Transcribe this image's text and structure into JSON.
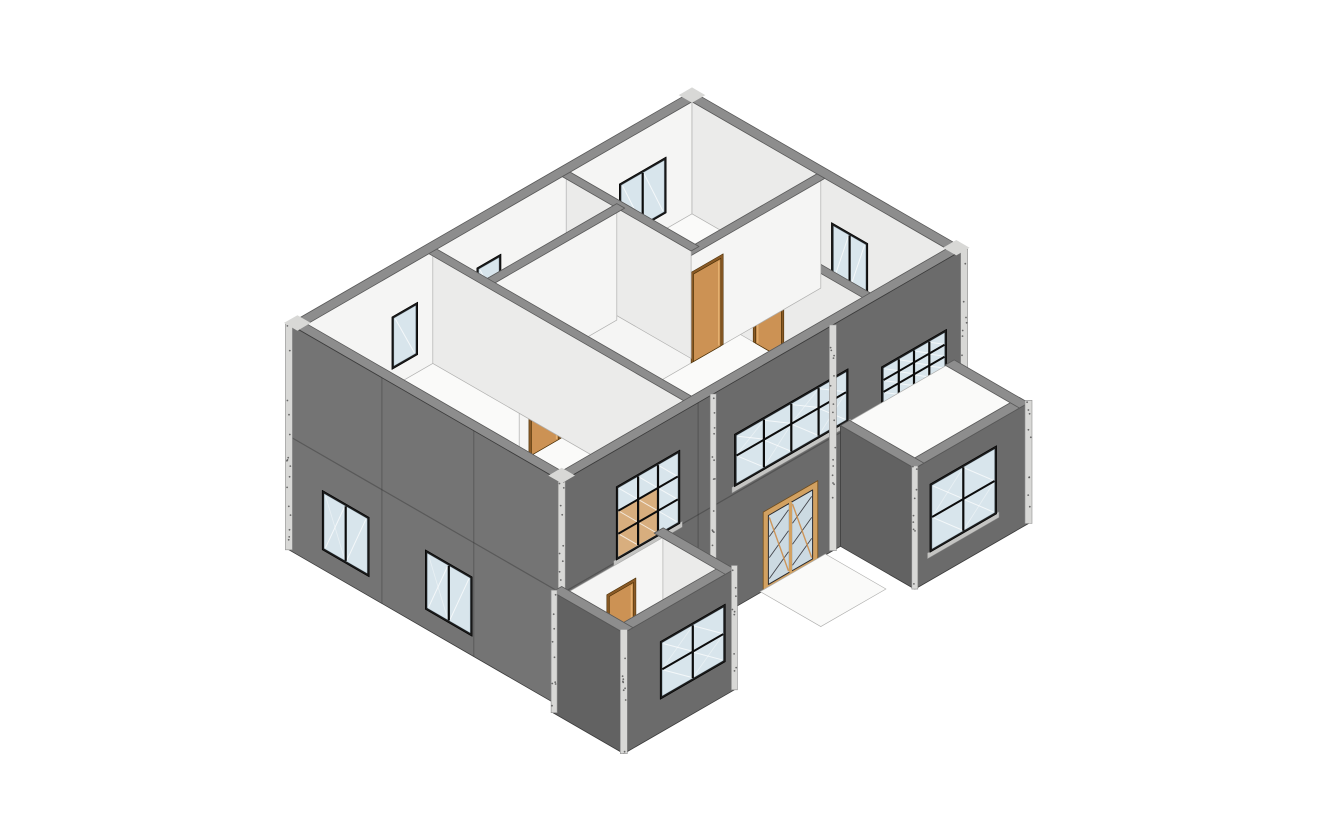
{
  "meta": {
    "title": "3D axonometric section view of a two-story building model"
  },
  "colors": {
    "bg": "#ffffff",
    "wallSW": "#747474",
    "wallSE": "#6b6b6b",
    "wallDark": "#626262",
    "cap": "#8d8d8d",
    "innerA": "#f5f5f4",
    "innerB": "#ebebea",
    "floor": "#fafaf9",
    "shaft": "#efefee",
    "shaftSide": "#e3e3e2",
    "trim": "#d8d8d6",
    "trimLight": "#b5b5b3",
    "speckle": "#565656",
    "frame": "#1a1a1a",
    "mullion": "#0c0c0c",
    "glass": "#d8e5ec",
    "glassTan": "#d8ae7e",
    "sill": "#c4c4c2",
    "door": "#cc9254",
    "doorLit": "#e5b271",
    "doorJamb": "#8a5a26",
    "entryFrame": "#d2a161",
    "entryGlass": "#ccdae2"
  },
  "projection": {
    "scale": 35,
    "ox": 692,
    "oy": 317
  },
  "scene": [
    {
      "t": "wx",
      "n": "stair-shaft-back-wall",
      "x": 7.5,
      "y0": 2.95,
      "y1": 4.9,
      "z0": 0.2,
      "z1": 3.25,
      "f": "shaftSide"
    },
    {
      "t": "top",
      "n": "stair-shaft-floor",
      "z": 0.2,
      "x0": 7.5,
      "x1": 8.75,
      "y0": 2.95,
      "y1": 4.9,
      "f": "shaft"
    },
    {
      "t": "doory",
      "n": "stair-ground-door",
      "y": 2.96,
      "x0": 7.72,
      "x1": 8.5,
      "z0": 0.5,
      "z1": 2.85
    },
    {
      "t": "top",
      "n": "upper-floor-slab",
      "z": 3.25,
      "x0": 0.25,
      "x1": 8.75,
      "y0": 0.25,
      "y1": 13.05,
      "hole": [
        7.5,
        8.75,
        2.95,
        4.9
      ],
      "f": "floor",
      "e": "l"
    },
    {
      "t": "top",
      "n": "stair-opening-trim",
      "z": 3.3,
      "x0": 7.36,
      "x1": 7.52,
      "y0": 2.95,
      "y1": 4.98,
      "f": "trimLight"
    },
    {
      "t": "top",
      "n": "stair-opening-trim",
      "z": 3.3,
      "x0": 7.36,
      "x1": 8.75,
      "y0": 4.86,
      "y1": 5.0,
      "f": "trimLight"
    },
    {
      "t": "wx",
      "n": "inner-wall-nw",
      "x": 0.3,
      "y0": 0.3,
      "y1": 13.05,
      "z0": 3.25,
      "z1": 6.45,
      "f": "innerA",
      "e": "l"
    },
    {
      "t": "winx",
      "n": "interior-window-nw-1",
      "x": 0.3,
      "y0": 1.15,
      "y1": 2.7,
      "z0": 3.7,
      "z1": 5.3,
      "cols": 2,
      "rows": 1
    },
    {
      "t": "winx",
      "n": "interior-window-nw-2",
      "x": 0.3,
      "y0": 6.6,
      "y1": 7.4,
      "z0": 3.75,
      "z1": 5.25,
      "cols": 1,
      "rows": 1
    },
    {
      "t": "winx",
      "n": "interior-window-nw-3",
      "x": 0.3,
      "y0": 9.35,
      "y1": 10.2,
      "z0": 3.75,
      "z1": 5.25,
      "cols": 1,
      "rows": 1
    },
    {
      "t": "wy",
      "n": "inner-wall-ne",
      "y": 0.3,
      "x0": 0.3,
      "x1": 8.75,
      "z0": 3.25,
      "z1": 6.45,
      "f": "innerB",
      "e": "l"
    },
    {
      "t": "winy",
      "n": "interior-window-ne-1",
      "y": 0.3,
      "x0": 4.9,
      "x1": 6.1,
      "z0": 3.7,
      "z1": 5.3,
      "cols": 2,
      "rows": 1
    },
    {
      "t": "winy",
      "n": "interior-window-ne-2",
      "y": 0.3,
      "x0": 7.55,
      "x1": 8.45,
      "z0": 3.7,
      "z1": 5.25,
      "cols": 1,
      "rows": 1
    },
    {
      "t": "top",
      "n": "wall-cap-nw",
      "z": 6.45,
      "x0": 0,
      "x1": 0.3,
      "y0": 0,
      "y1": 13.3,
      "f": "cap",
      "e": "c"
    },
    {
      "t": "top",
      "n": "wall-cap-ne",
      "z": 6.45,
      "x0": 0,
      "x1": 9,
      "y0": 0,
      "y1": 0.3,
      "f": "cap",
      "e": "c"
    },
    {
      "t": "wy",
      "n": "partition-wall-right",
      "y": 2.95,
      "x0": 4.55,
      "x1": 8.75,
      "z0": 3.25,
      "z1": 6.45,
      "f": "innerB",
      "e": "l"
    },
    {
      "t": "doory",
      "n": "interior-door-3",
      "y": 2.95,
      "x0": 5.05,
      "x1": 5.9,
      "z0": 3.25,
      "z1": 5.6
    },
    {
      "t": "top",
      "n": "partition-cap",
      "z": 6.45,
      "x0": 4.45,
      "x1": 8.75,
      "y0": 2.82,
      "y1": 3.08,
      "f": "cap",
      "e": "c"
    },
    {
      "t": "wx",
      "n": "partition-wall-mid",
      "x": 4.55,
      "y0": 0.3,
      "y1": 10.25,
      "z0": 3.25,
      "z1": 6.45,
      "f": "innerA",
      "e": "l"
    },
    {
      "t": "doorx",
      "n": "interior-door-2",
      "x": 4.55,
      "y0": 3.6,
      "y1": 4.5,
      "z0": 3.25,
      "z1": 5.75
    },
    {
      "t": "doorx",
      "n": "interior-door-1",
      "x": 4.55,
      "y0": 8.95,
      "y1": 9.85,
      "z0": 3.25,
      "z1": 5.8
    },
    {
      "t": "top",
      "n": "partition-cap",
      "z": 6.45,
      "x0": 4.42,
      "x1": 4.68,
      "y0": 0.3,
      "y1": 10.25,
      "f": "cap",
      "e": "c"
    },
    {
      "t": "wy",
      "n": "partition-wall-left",
      "y": 4.45,
      "x0": 0.3,
      "x1": 4.42,
      "z0": 3.25,
      "z1": 6.45,
      "f": "innerB",
      "e": "l"
    },
    {
      "t": "top",
      "n": "partition-cap",
      "z": 6.45,
      "x0": 0.3,
      "x1": 4.55,
      "y0": 4.32,
      "y1": 4.58,
      "f": "cap",
      "e": "c"
    },
    {
      "t": "wx",
      "n": "partition-wall-small",
      "x": 2.1,
      "y0": 4.58,
      "y1": 8.85,
      "z0": 3.25,
      "z1": 6.45,
      "f": "innerA",
      "e": "l"
    },
    {
      "t": "top",
      "n": "partition-cap",
      "z": 6.45,
      "x0": 1.97,
      "x1": 2.23,
      "y0": 4.45,
      "y1": 8.85,
      "f": "cap",
      "e": "c"
    },
    {
      "t": "wy",
      "n": "partition-wall-front",
      "y": 8.85,
      "x0": 0.3,
      "x1": 8.75,
      "z0": 3.25,
      "z1": 6.45,
      "f": "innerB",
      "e": "l"
    },
    {
      "t": "top",
      "n": "partition-cap",
      "z": 6.45,
      "x0": 0.3,
      "x1": 8.75,
      "y0": 8.72,
      "y1": 8.98,
      "f": "cap",
      "e": "c"
    },
    {
      "t": "top",
      "n": "wall-cap-se",
      "z": 6.45,
      "x0": 8.7,
      "x1": 9,
      "y0": 0,
      "y1": 13.3,
      "f": "cap",
      "e": "c"
    },
    {
      "t": "top",
      "n": "wall-cap-sw",
      "z": 6.45,
      "x0": 0,
      "x1": 9,
      "y0": 13,
      "y1": 13.3,
      "f": "cap",
      "e": "c"
    },
    {
      "t": "wy",
      "n": "exterior-wall-sw",
      "y": 13.3,
      "x0": 0,
      "x1": 9,
      "z0": 0,
      "z1": 6.45,
      "f": "wallSW",
      "e": "d"
    },
    {
      "t": "line",
      "n": "panel-joint",
      "pts": [
        [
          0,
          13.3,
          3.25
        ],
        [
          9,
          13.3,
          3.25
        ]
      ],
      "w": 1.2
    },
    {
      "t": "line",
      "n": "panel-joint",
      "pts": [
        [
          3.07,
          13.3,
          0
        ],
        [
          3.07,
          13.3,
          6.45
        ]
      ],
      "w": 1
    },
    {
      "t": "line",
      "n": "panel-joint",
      "pts": [
        [
          6.1,
          13.3,
          0
        ],
        [
          6.1,
          13.3,
          6.45
        ]
      ],
      "w": 1
    },
    {
      "t": "winy",
      "n": "window-sw-1",
      "y": 13.3,
      "x0": 1.1,
      "x1": 2.65,
      "z0": 0.55,
      "z1": 2.25,
      "cols": 2,
      "rows": 1,
      "diag": true
    },
    {
      "t": "winy",
      "n": "window-sw-2",
      "y": 13.3,
      "x0": 4.5,
      "x1": 6.05,
      "z0": 0.55,
      "z1": 2.25,
      "cols": 2,
      "rows": 1,
      "diag": true
    },
    {
      "t": "wx",
      "n": "exterior-wall-se",
      "x": 9,
      "y0": 0,
      "y1": 13.3,
      "z0": 0,
      "z1": 6.45,
      "f": "wallSE",
      "e": "d"
    },
    {
      "t": "line",
      "n": "panel-joint",
      "pts": [
        [
          9,
          0,
          3.25
        ],
        [
          9,
          13.3,
          3.25
        ]
      ],
      "w": 1.2
    },
    {
      "t": "line",
      "n": "panel-joint",
      "pts": [
        [
          9,
          8.8,
          0
        ],
        [
          9,
          8.8,
          6.45
        ]
      ],
      "w": 1
    },
    {
      "t": "winx",
      "n": "window-band",
      "x": 9,
      "y0": 3.85,
      "y1": 7.6,
      "z0": 3.45,
      "z1": 4.95,
      "cols": 4,
      "rows": 2,
      "rs": [
        0.58
      ],
      "diag": true,
      "sill": true
    },
    {
      "t": "winx",
      "n": "window-grid-3x3",
      "x": 9,
      "y0": 9.4,
      "y1": 11.5,
      "z0": 3.3,
      "z1": 5.4,
      "cols": 3,
      "rows": 3,
      "sill": true,
      "tint": [
        [
          2,
          0
        ],
        [
          2,
          1
        ],
        [
          1,
          0
        ],
        [
          1,
          1
        ]
      ]
    },
    {
      "t": "winx",
      "n": "window-grid-4x4",
      "x": 9,
      "y0": 0.6,
      "y1": 2.75,
      "z0": 2.95,
      "z1": 4.45,
      "cols": 4,
      "rows": 4,
      "sill": true
    },
    {
      "t": "entry",
      "n": "entry-door",
      "x": 9,
      "y0": 4.95,
      "y1": 6.55,
      "z0": 0,
      "z1": 2.15
    },
    {
      "t": "top",
      "n": "entry-walkway",
      "z": 0.03,
      "x0": 9,
      "x1": 11.0,
      "y0": 4.6,
      "y1": 6.75,
      "f": "floor",
      "e": "l"
    },
    {
      "t": "pillar",
      "n": "facade-trim-pillar",
      "x": 9,
      "y": 4.35,
      "z0": 0,
      "z1": 6.45,
      "w": 7
    },
    {
      "t": "pillar",
      "n": "facade-trim-pillar",
      "x": 9,
      "y": 8.3,
      "z0": 0,
      "z1": 6.45,
      "w": 6
    },
    {
      "t": "pillar",
      "n": "corner-trim-pillar",
      "x": 9,
      "y": 0.02,
      "z0": 0,
      "z1": 6.45,
      "w": 7
    },
    {
      "t": "pillar",
      "n": "corner-trim-pillar",
      "x": 0,
      "y": 13.3,
      "z0": 0,
      "z1": 6.45,
      "w": 7
    },
    {
      "t": "pillar",
      "n": "corner-trim-pillar",
      "x": 9,
      "y": 13.3,
      "z0": 0,
      "z1": 6.45,
      "w": 7
    },
    {
      "t": "top",
      "n": "corner-cap-block",
      "z": 6.48,
      "x0": -0.08,
      "x1": 0.36,
      "y0": -0.08,
      "y1": 0.36,
      "f": "trim"
    },
    {
      "t": "top",
      "n": "corner-cap-block",
      "z": 6.48,
      "x0": -0.08,
      "x1": 0.36,
      "y0": 12.94,
      "y1": 13.38,
      "f": "trim"
    },
    {
      "t": "top",
      "n": "corner-cap-block",
      "z": 6.48,
      "x0": 8.64,
      "x1": 9.08,
      "y0": -0.08,
      "y1": 0.36,
      "f": "trim"
    },
    {
      "t": "top",
      "n": "corner-cap-block",
      "z": 6.48,
      "x0": 8.64,
      "x1": 9.08,
      "y0": 12.94,
      "y1": 13.38,
      "f": "trim"
    },
    {
      "t": "top",
      "n": "bumpout-roof",
      "z": 3.42,
      "x0": 9,
      "x1": 11.32,
      "y0": 0.48,
      "y1": 3.97,
      "f": "floor",
      "e": "l"
    },
    {
      "t": "wy",
      "n": "bumpout-wall-sw",
      "y": 4.1,
      "x0": 9,
      "x1": 11.45,
      "z0": 0,
      "z1": 3.45,
      "f": "wallDark",
      "e": "d"
    },
    {
      "t": "wx",
      "n": "bumpout-wall-se",
      "x": 11.45,
      "y0": 0.35,
      "y1": 4.1,
      "z0": 0,
      "z1": 3.45,
      "f": "wallSE",
      "e": "d"
    },
    {
      "t": "winx",
      "n": "bumpout-window",
      "x": 11.45,
      "y0": 1.4,
      "y1": 3.6,
      "z0": 0.8,
      "z1": 2.75,
      "cols": 2,
      "rows": 2,
      "diag": true,
      "sill": true
    },
    {
      "t": "top",
      "n": "bumpout-cap",
      "z": 3.45,
      "x0": 11.15,
      "x1": 11.45,
      "y0": 0.35,
      "y1": 4.1,
      "f": "cap",
      "e": "c"
    },
    {
      "t": "top",
      "n": "bumpout-cap",
      "z": 3.45,
      "x0": 9,
      "x1": 11.45,
      "y0": 3.8,
      "y1": 4.1,
      "f": "cap",
      "e": "c"
    },
    {
      "t": "top",
      "n": "bumpout-cap",
      "z": 3.45,
      "x0": 9,
      "x1": 11.45,
      "y0": 0.35,
      "y1": 0.65,
      "f": "cap",
      "e": "c"
    },
    {
      "t": "pillar",
      "n": "bumpout-corner-pillar",
      "x": 11.45,
      "y": 0.35,
      "z0": 0,
      "z1": 3.52,
      "w": 7
    },
    {
      "t": "pillar",
      "n": "bumpout-corner-pillar",
      "x": 11.45,
      "y": 4.1,
      "z0": 0,
      "z1": 3.52,
      "w": 6
    },
    {
      "t": "wx",
      "n": "porch-back-wall",
      "x": 9.02,
      "y0": 9.95,
      "y1": 13.15,
      "z0": 0,
      "z1": 3.2,
      "f": "innerA",
      "e": "l"
    },
    {
      "t": "doorx",
      "n": "porch-door",
      "x": 9.02,
      "y0": 10.95,
      "y1": 11.75,
      "z0": 0,
      "z1": 2.4
    },
    {
      "t": "wy",
      "n": "porch-inner-wall",
      "y": 9.98,
      "x0": 9.02,
      "x1": 11.35,
      "z0": 0,
      "z1": 3.45,
      "f": "innerB",
      "e": "l"
    },
    {
      "t": "top",
      "n": "porch-floor",
      "z": 0.12,
      "x0": 9,
      "x1": 11.2,
      "y0": 10.1,
      "y1": 13.42,
      "f": "floor",
      "e": "l"
    },
    {
      "t": "wx",
      "n": "porch-wall-se",
      "x": 11.35,
      "y0": 9.95,
      "y1": 13.6,
      "z0": 0,
      "z1": 3.45,
      "f": "wallSE",
      "e": "d"
    },
    {
      "t": "winx",
      "n": "porch-window",
      "x": 11.35,
      "y0": 10.25,
      "y1": 12.4,
      "z0": 0.95,
      "z1": 2.6,
      "cols": 2,
      "rows": 2,
      "diag": true
    },
    {
      "t": "wy",
      "n": "porch-wall-sw",
      "y": 13.6,
      "x0": 9,
      "x1": 11.35,
      "z0": 0,
      "z1": 3.45,
      "f": "wallDark",
      "e": "d"
    },
    {
      "t": "top",
      "n": "porch-cap",
      "z": 3.45,
      "x0": 11.05,
      "x1": 11.35,
      "y0": 9.95,
      "y1": 13.6,
      "f": "cap",
      "e": "c"
    },
    {
      "t": "top",
      "n": "porch-cap",
      "z": 3.45,
      "x0": 9,
      "x1": 11.35,
      "y0": 13.3,
      "y1": 13.6,
      "f": "cap",
      "e": "c"
    },
    {
      "t": "top",
      "n": "porch-cap",
      "z": 3.45,
      "x0": 9,
      "x1": 11.35,
      "y0": 9.95,
      "y1": 10.25,
      "f": "cap",
      "e": "c"
    },
    {
      "t": "pillar",
      "n": "porch-corner-pillar",
      "x": 11.35,
      "y": 13.6,
      "z0": 0,
      "z1": 3.55,
      "w": 7
    },
    {
      "t": "pillar",
      "n": "porch-corner-pillar",
      "x": 11.35,
      "y": 9.95,
      "z0": 0,
      "z1": 3.55,
      "w": 6
    },
    {
      "t": "pillar",
      "n": "porch-corner-pillar",
      "x": 9.03,
      "y": 13.58,
      "z0": 0,
      "z1": 3.5,
      "w": 6
    }
  ]
}
